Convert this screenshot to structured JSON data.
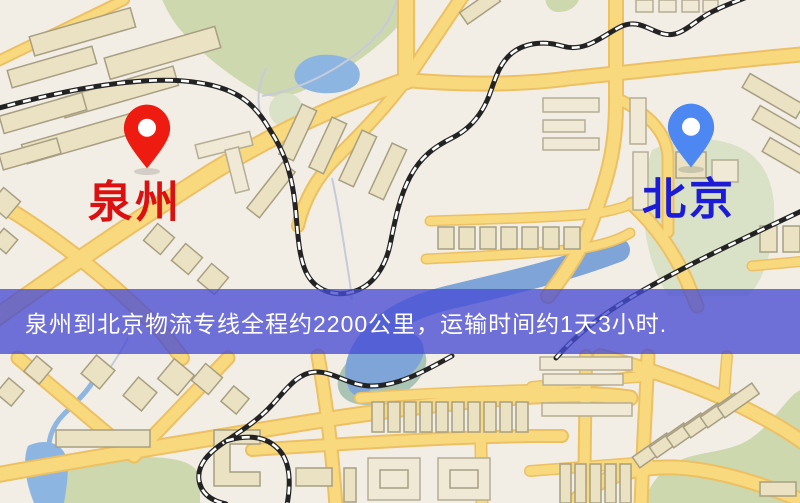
{
  "map": {
    "markers": {
      "origin": {
        "label": "泉州",
        "pin_color": "#ee1b10",
        "label_color": "#dc1010"
      },
      "destination": {
        "label": "北京",
        "pin_color": "#4d87f2",
        "label_color": "#1b1bd8"
      }
    },
    "banner": {
      "text": "泉州到北京物流专线全程约2200公里，运输时间约1天3小时.",
      "background_color": "#484ed4",
      "text_color": "#ffffff"
    },
    "palette": {
      "background": "#f3eee5",
      "road": "#f8d97e",
      "road_casing": "#ecc063",
      "park": "#cdd8ae",
      "water": "#8db5e1",
      "building": "#eae2c3",
      "railway": "#232323"
    }
  }
}
